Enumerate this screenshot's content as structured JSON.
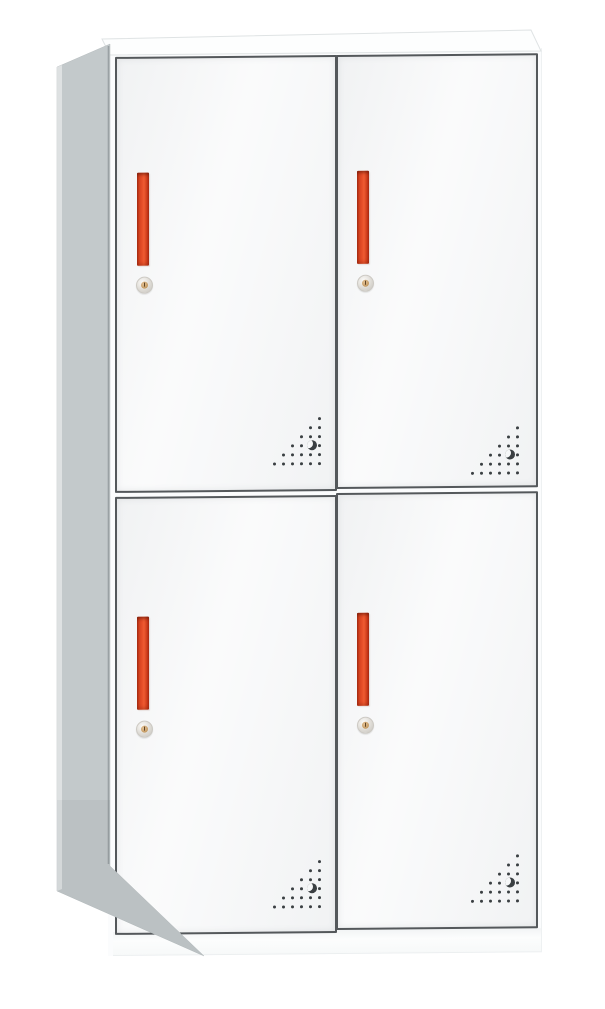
{
  "scene": {
    "type": "product-photo",
    "subject": "four-door steel locker cabinet",
    "view": "front view with slight left-side and top perspective",
    "background_color": "#ffffff"
  },
  "cabinet": {
    "sections": 2,
    "doors_per_section": 2,
    "door_count": 4,
    "colors": {
      "background": "#ffffff",
      "body": "#fbfcfd",
      "top_face": "#fdfefe",
      "side_panel": "#c3c9cb",
      "side_panel_edge": "#9aa1a4",
      "door_fill": "#f6f7f8",
      "frame": "#54585b",
      "handle": "#e8502a",
      "handle_dark": "#a82c12",
      "lock_body": "#dcd9d3",
      "lock_core": "#c49a62",
      "vent_dot": "#3a3f42"
    },
    "doors": [
      {
        "id": "upper-left",
        "handle": "red-vertical-bar-handle",
        "lock": "keyhole-cam-lock",
        "vent": "bottom-right-corner-dot-perforation"
      },
      {
        "id": "upper-right",
        "handle": "red-vertical-bar-handle",
        "lock": "keyhole-cam-lock",
        "vent": "bottom-right-corner-dot-perforation"
      },
      {
        "id": "lower-left",
        "handle": "red-vertical-bar-handle",
        "lock": "keyhole-cam-lock",
        "vent": "bottom-right-corner-dot-perforation"
      },
      {
        "id": "lower-right",
        "handle": "red-vertical-bar-handle",
        "lock": "keyhole-cam-lock",
        "vent": "bottom-right-corner-dot-perforation"
      }
    ],
    "vent_pattern": {
      "grid": 6,
      "cell_px": 9,
      "dot_px": 3,
      "rows": [
        [
          5
        ],
        [
          4,
          5
        ],
        [
          3,
          4,
          5
        ],
        [
          2,
          3,
          5
        ],
        [
          1,
          2,
          3,
          4,
          5
        ],
        [
          0,
          1,
          2,
          3,
          4,
          5
        ]
      ],
      "crescent": {
        "row": 3,
        "col": 4
      }
    }
  }
}
